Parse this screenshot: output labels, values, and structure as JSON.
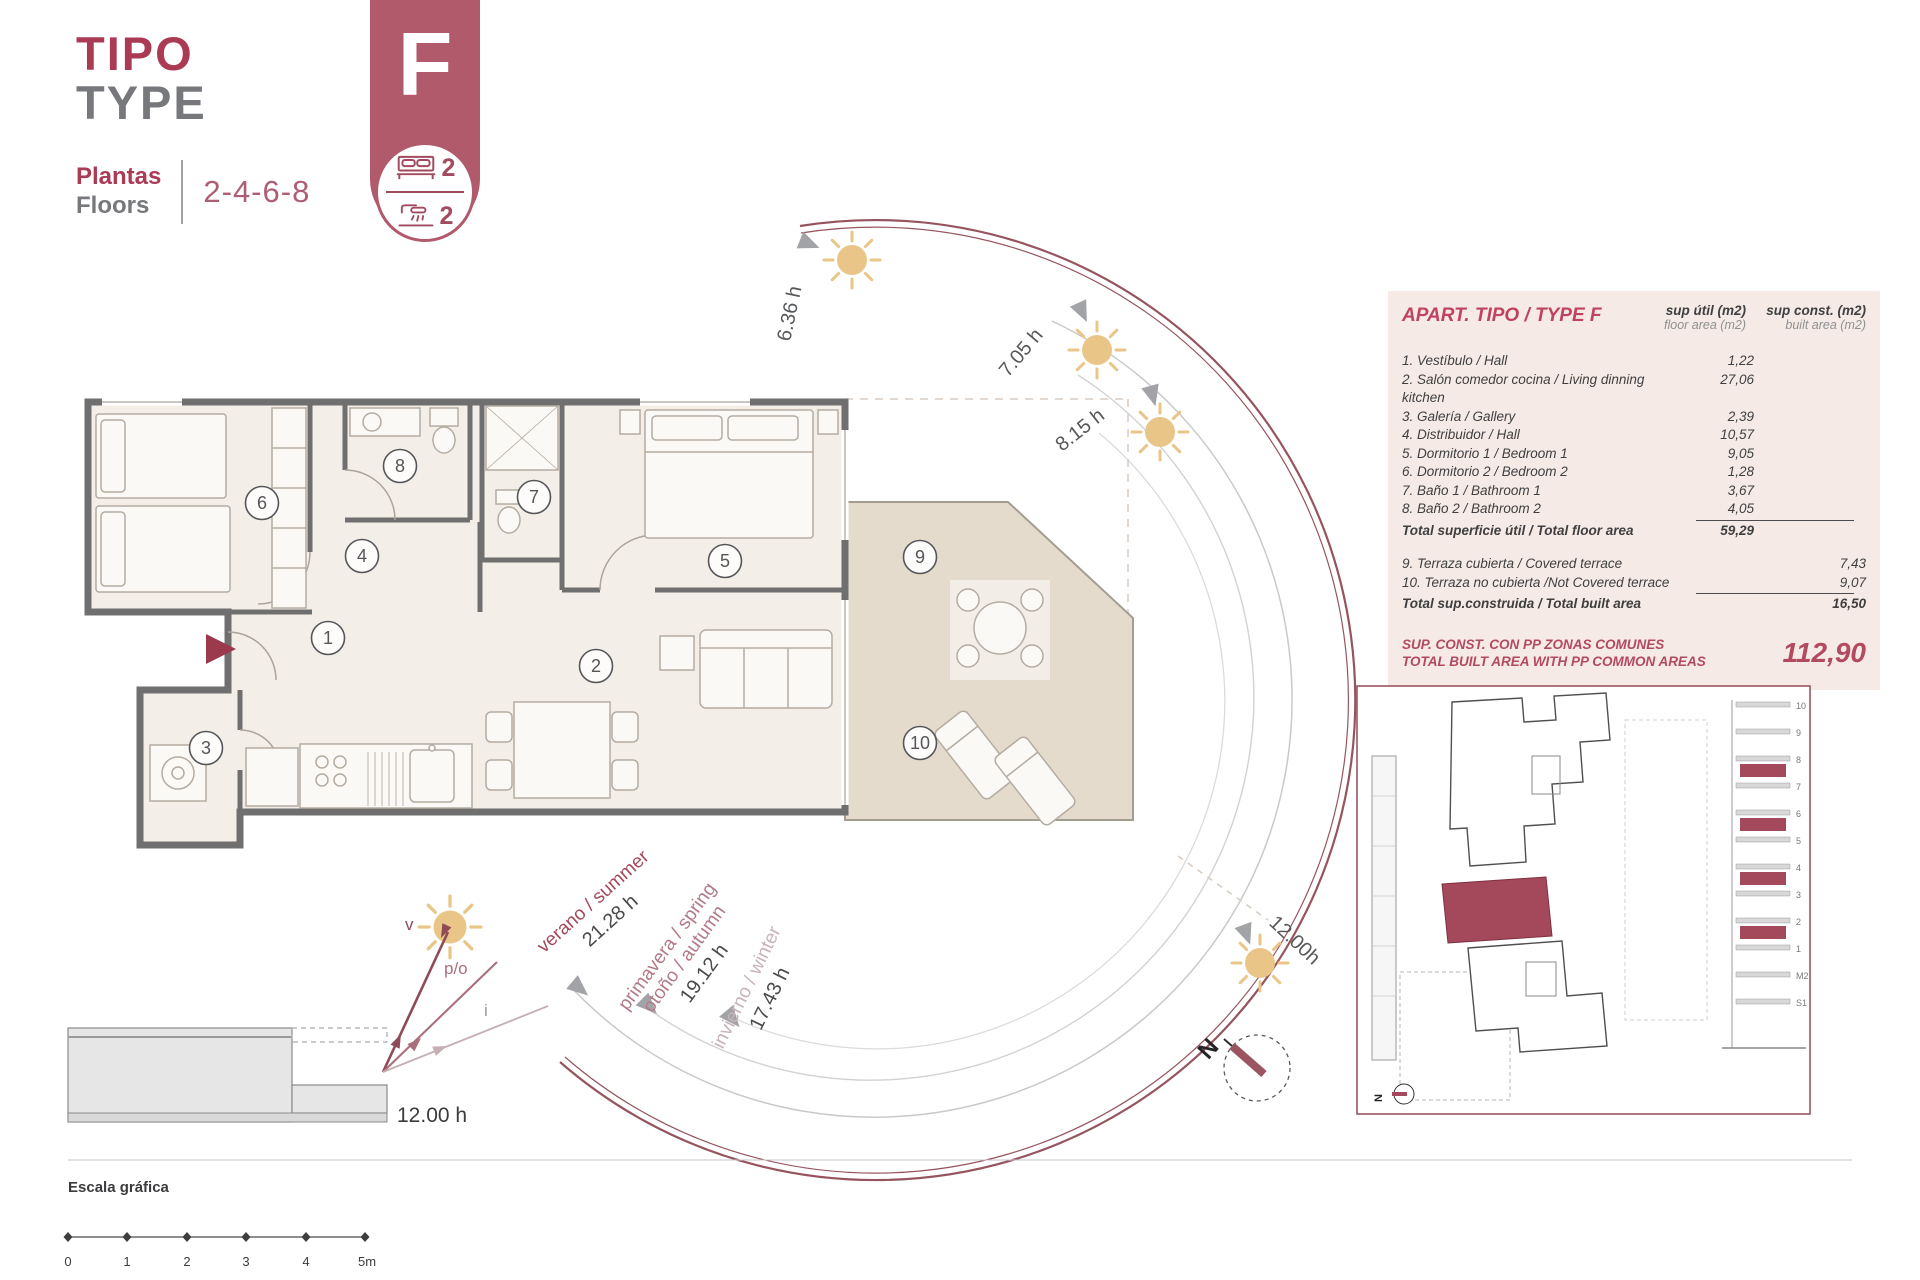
{
  "header": {
    "title_es": "TIPO",
    "title_en": "TYPE",
    "floors_label_es": "Plantas",
    "floors_label_en": "Floors",
    "floors_value": "2-4-6-8",
    "type_letter": "F",
    "bedrooms": "2",
    "bathrooms": "2"
  },
  "table": {
    "title": "APART. TIPO / TYPE F",
    "col_floor": {
      "line1": "sup útil (m2)",
      "line2": "floor area (m2)"
    },
    "col_built": {
      "line1": "sup const. (m2)",
      "line2": "built area (m2)"
    },
    "rows": [
      {
        "label": "1. Vestíbulo / Hall",
        "floor_area": "1,22"
      },
      {
        "label": "2. Salón comedor cocina / Living dinning kitchen",
        "floor_area": "27,06"
      },
      {
        "label": "3. Galería / Gallery",
        "floor_area": "2,39"
      },
      {
        "label": "4. Distribuidor / Hall",
        "floor_area": "10,57"
      },
      {
        "label": "5. Dormitorio 1 / Bedroom 1",
        "floor_area": "9,05"
      },
      {
        "label": "6. Dormitorio 2 / Bedroom 2",
        "floor_area": "1,28"
      },
      {
        "label": "7. Baño 1 / Bathroom 1",
        "floor_area": "3,67"
      },
      {
        "label": "8. Baño 2 / Bathroom 2",
        "floor_area": "4,05"
      }
    ],
    "total_floor": {
      "label": "Total superficie útil / Total floor area",
      "value": "59,29"
    },
    "terrace_rows": [
      {
        "label": "9. Terraza cubierta / Covered terrace",
        "built_area": "7,43"
      },
      {
        "label": "10. Terraza no cubierta /Not Covered terrace",
        "built_area": "9,07"
      }
    ],
    "total_built": {
      "label": "Total sup.construida / Total built area",
      "value": "16,50"
    },
    "grand_total": {
      "line1": "SUP. CONST. CON PP ZONAS COMUNES",
      "line2": "TOTAL BUILT AREA WITH PP COMMON AREAS",
      "value": "112,90"
    }
  },
  "sun_path": {
    "hours": [
      {
        "label": "6.36 h"
      },
      {
        "label": "7.05 h"
      },
      {
        "label": "8.15 h"
      },
      {
        "label": "12.00h"
      }
    ],
    "seasons": [
      {
        "line1": "verano / summer",
        "hours": "21.28 h"
      },
      {
        "line1": "primavera / spring",
        "line2": "otoño / autumn",
        "hours": "19.12 h"
      },
      {
        "line1": "invierno / winter",
        "hours": "17.43 h"
      }
    ]
  },
  "section": {
    "noon_label": "12.00 h",
    "ray_labels": [
      "v",
      "p/o",
      "i"
    ]
  },
  "compass": {
    "north": "N"
  },
  "scale_bar": {
    "title": "Escala gráfica",
    "ticks": [
      "0",
      "1",
      "2",
      "3",
      "4",
      "5m"
    ]
  },
  "floor_plan": {
    "room_numbers": [
      "1",
      "2",
      "3",
      "4",
      "5",
      "6",
      "7",
      "8",
      "9",
      "10"
    ]
  },
  "inset": {
    "north": "N",
    "floor_labels": [
      "10",
      "9",
      "8",
      "7",
      "6",
      "5",
      "4",
      "3",
      "2",
      "1",
      "M2",
      "S1"
    ]
  },
  "colors": {
    "brand": "#ab3a55",
    "badge": "#b15a6b",
    "arc": "#96555e",
    "sun": "#e9c687",
    "terrace_fill": "#e5dbcd",
    "wall": "#6f6f70",
    "table_bg": "#f5eae5",
    "season_summer": "#a4495c",
    "season_spring": "#b27a86",
    "season_winter": "#c8b3b8"
  }
}
